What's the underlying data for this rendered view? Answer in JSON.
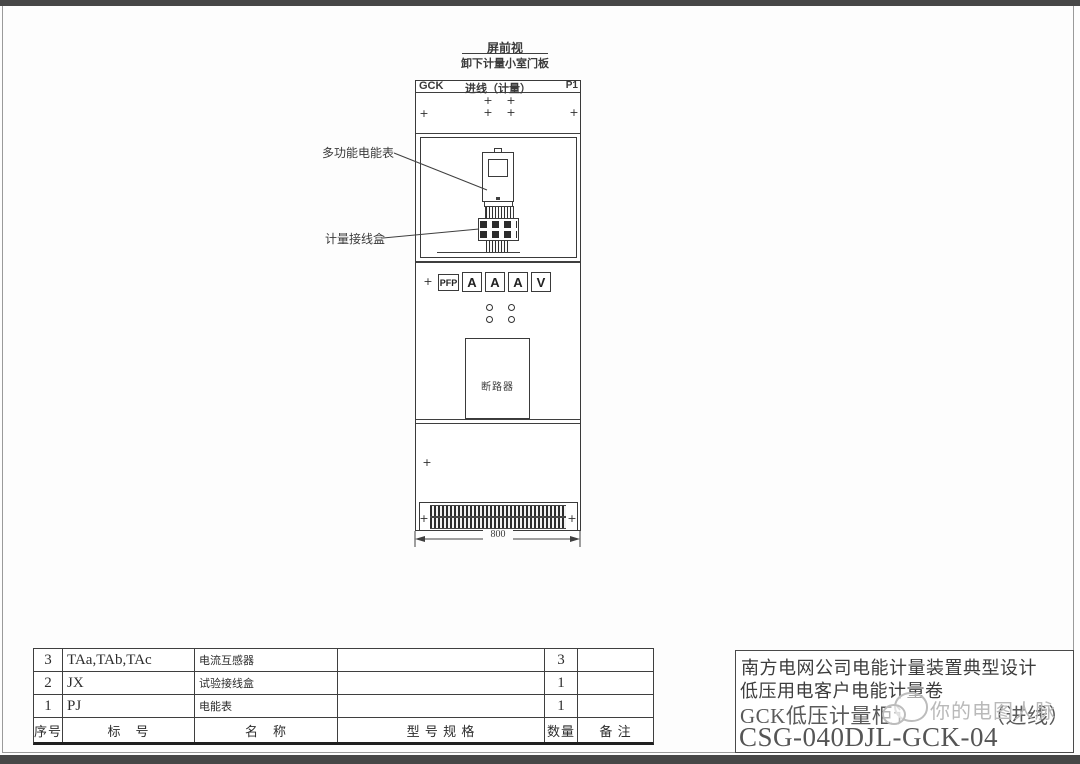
{
  "view": {
    "title": "屏前视",
    "subtitle": "卸下计量小室门板"
  },
  "cabinet": {
    "header_left": "GCK",
    "header_center": "进线（计量）",
    "header_right": "P1",
    "meter_label": "多功能电能表",
    "terminal_box_label": "计量接线盒",
    "panel_button_label": "PFP",
    "instruments": [
      "A",
      "A",
      "A",
      "V"
    ],
    "breaker_label": "断路器",
    "width_dimension": "800"
  },
  "parts_table": {
    "headers": {
      "seq": "序号",
      "mark": "标　号",
      "name": "名　称",
      "spec": "型 号 规 格",
      "qty": "数量",
      "note": "备 注"
    },
    "rows": [
      {
        "seq": "3",
        "mark": "TAa,TAb,TAc",
        "name": "电流互感器",
        "spec": "",
        "qty": "3",
        "note": ""
      },
      {
        "seq": "2",
        "mark": "JX",
        "name": "试验接线盒",
        "spec": "",
        "qty": "1",
        "note": ""
      },
      {
        "seq": "1",
        "mark": "PJ",
        "name": "电能表",
        "spec": "",
        "qty": "1",
        "note": ""
      }
    ]
  },
  "title_block": {
    "line1": "南方电网公司电能计量装置典型设计",
    "line2": "低压用电客户电能计量卷",
    "line3_prefix": "GCK低压计量柜讠",
    "line3_suffix": "（进线）",
    "line4": "CSG-040DJL-GCK-04"
  },
  "watermark": {
    "text": "你的电图人脉"
  },
  "icons": {
    "screw": "+"
  },
  "colors": {
    "line": "#3f3f3f",
    "frame": "#9a9a9a",
    "top_bottom_bar": "#474747",
    "watermark": "#b5b5b5"
  }
}
